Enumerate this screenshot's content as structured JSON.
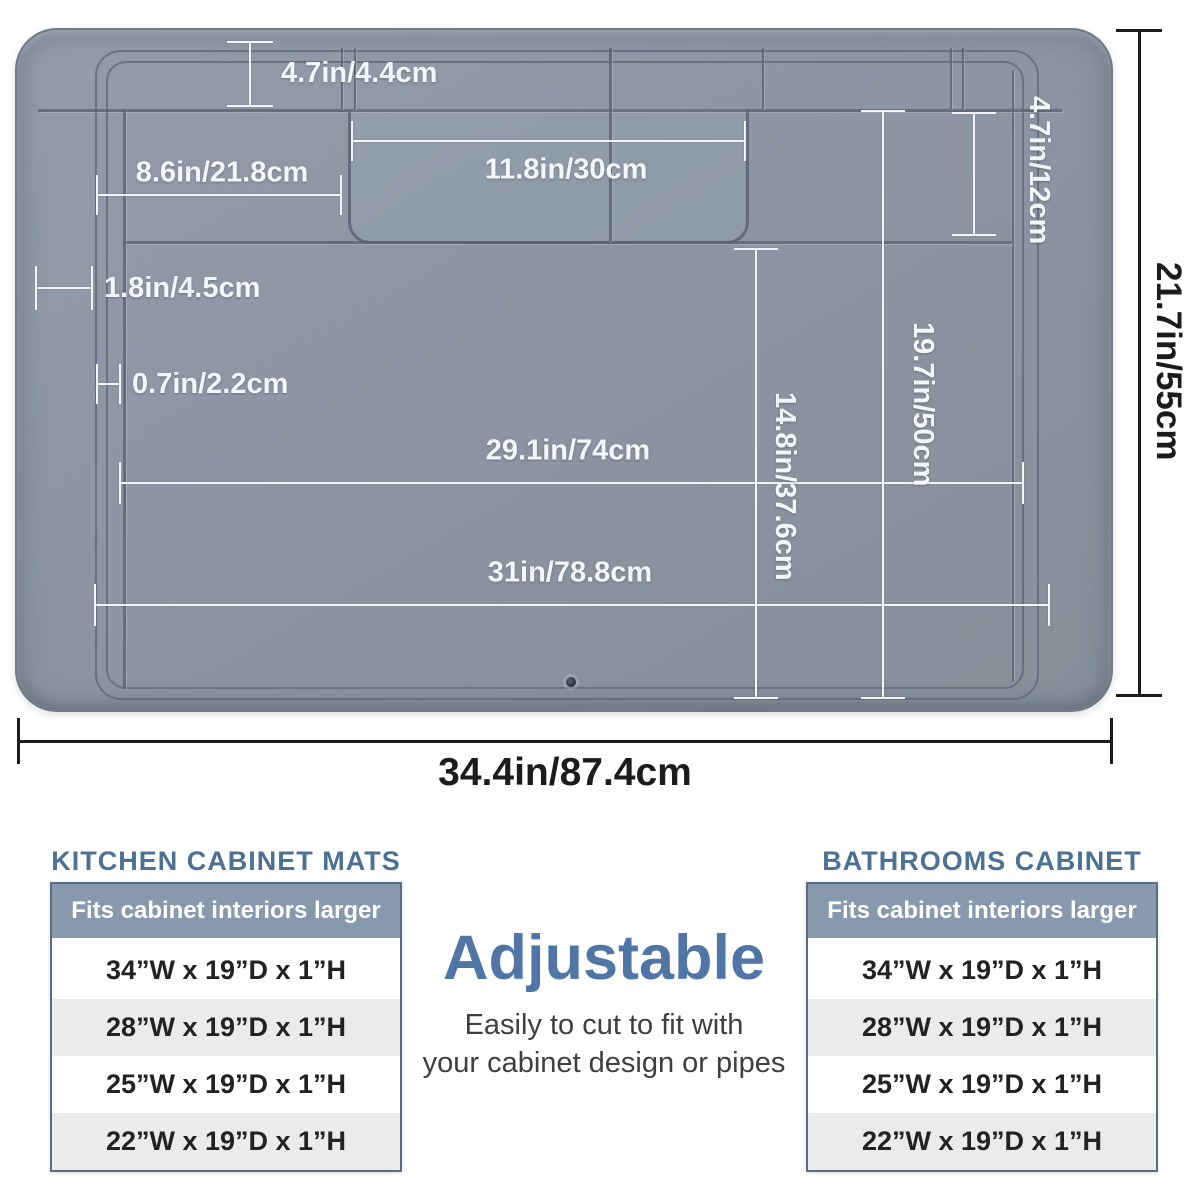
{
  "diagram": {
    "dims": {
      "top_strip_height": "4.7in/4.4cm",
      "left_tray_width": "8.6in/21.8cm",
      "center_tray_width": "11.8in/30cm",
      "upper_section_height": "4.7in/12cm",
      "edge_wall_width": "1.8in/4.5cm",
      "ridge_spacing": "0.7in/2.2cm",
      "main_area_width": "29.1in/74cm",
      "base_width": "31in/78.8cm",
      "main_area_height": "14.8in/37.6cm",
      "right_area_height": "19.7in/50cm",
      "overall_height": "21.7in/55cm",
      "overall_width": "34.4in/87.4cm"
    }
  },
  "tables": {
    "kitchen": {
      "title": "KITCHEN CABINET MATS",
      "header": "Fits cabinet interiors larger than",
      "rows": [
        "34”W x 19”D x 1”H",
        "28”W x 19”D x 1”H",
        "25”W x 19”D x 1”H",
        "22”W x 19”D x 1”H"
      ]
    },
    "bathroom": {
      "title": "BATHROOMS CABINET MATS",
      "header": "Fits cabinet interiors larger than",
      "rows": [
        "34”W x 19”D x 1”H",
        "28”W x 19”D x 1”H",
        "25”W x 19”D x 1”H",
        "22”W x 19”D x 1”H"
      ]
    }
  },
  "center": {
    "headline": "Adjustable",
    "subline1": "Easily to cut to fit with",
    "subline2": "your cabinet design or pipes"
  },
  "colors": {
    "mat-gray": "#8c96a3",
    "ridge": "#5c6676",
    "title-blue": "#4d7194",
    "accent-blue": "#4f76a5",
    "header-bg": "#8799ac",
    "row-alt": "#ebebeb",
    "table-border": "#5d6c7e",
    "dim-white": "#f4f7fa",
    "dim-black": "#1c1c1c"
  }
}
